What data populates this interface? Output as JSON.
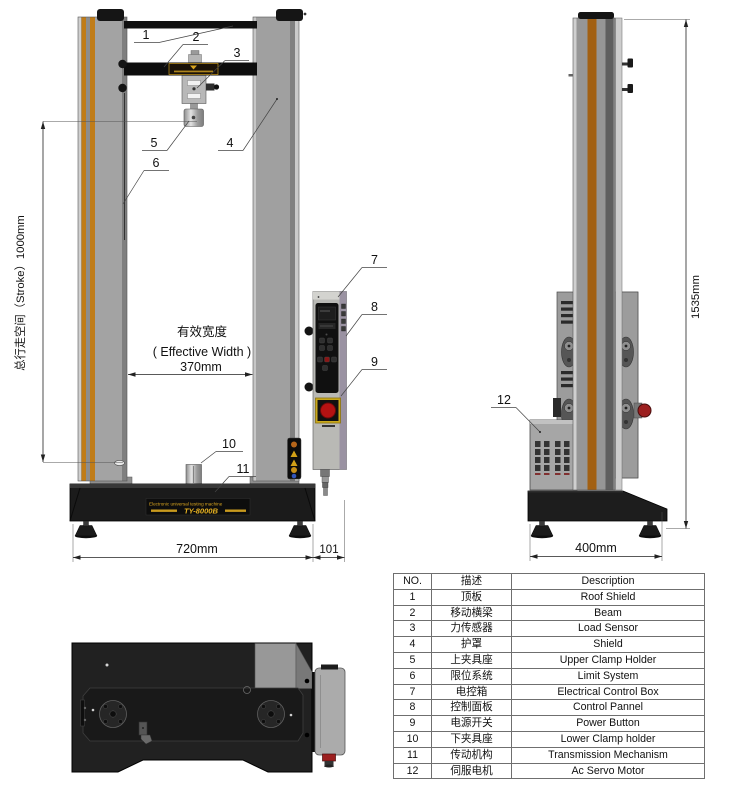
{
  "front_view": {
    "stroke_dim_label": "总行走空间（Stroke）1000mm",
    "effective_width_cn": "有效宽度",
    "effective_width_en": "( Effective Width )",
    "effective_width_value": "370mm",
    "base_width_value": "720mm",
    "control_box_width_value": "101",
    "base_plate_line1": "Electronic universal testing machine",
    "base_plate_model": "TY-8000B",
    "callouts": [
      "1",
      "2",
      "3",
      "4",
      "5",
      "6",
      "7",
      "8",
      "9",
      "10",
      "11"
    ]
  },
  "side_view": {
    "height_value": "1535mm",
    "depth_value": "400mm",
    "callout_motor": "12"
  },
  "parts_table": {
    "headers": {
      "no": "NO.",
      "cn": "描述",
      "en": "Description"
    },
    "rows": [
      {
        "no": "1",
        "cn": "顶板",
        "en": "Roof Shield"
      },
      {
        "no": "2",
        "cn": "移动横梁",
        "en": "Beam"
      },
      {
        "no": "3",
        "cn": "力传感器",
        "en": "Load Sensor"
      },
      {
        "no": "4",
        "cn": "护罩",
        "en": "Shield"
      },
      {
        "no": "5",
        "cn": "上夹具座",
        "en": "Upper Clamp Holder"
      },
      {
        "no": "6",
        "cn": "限位系统",
        "en": "Limit System"
      },
      {
        "no": "7",
        "cn": "电控箱",
        "en": "Electrical Control Box"
      },
      {
        "no": "8",
        "cn": "控制面板",
        "en": "Control Pannel"
      },
      {
        "no": "9",
        "cn": "电源开关",
        "en": "Power Button"
      },
      {
        "no": "10",
        "cn": "下夹具座",
        "en": "Lower Clamp holder"
      },
      {
        "no": "11",
        "cn": "传动机构",
        "en": "Transmission Mechanism"
      },
      {
        "no": "12",
        "cn": "伺服电机",
        "en": "Ac Servo Motor"
      }
    ]
  },
  "colors": {
    "column_orange": "#c07c18",
    "accent_gold": "#d9a520",
    "emergency_red": "#b51212",
    "base_black": "#1b1b1b"
  }
}
